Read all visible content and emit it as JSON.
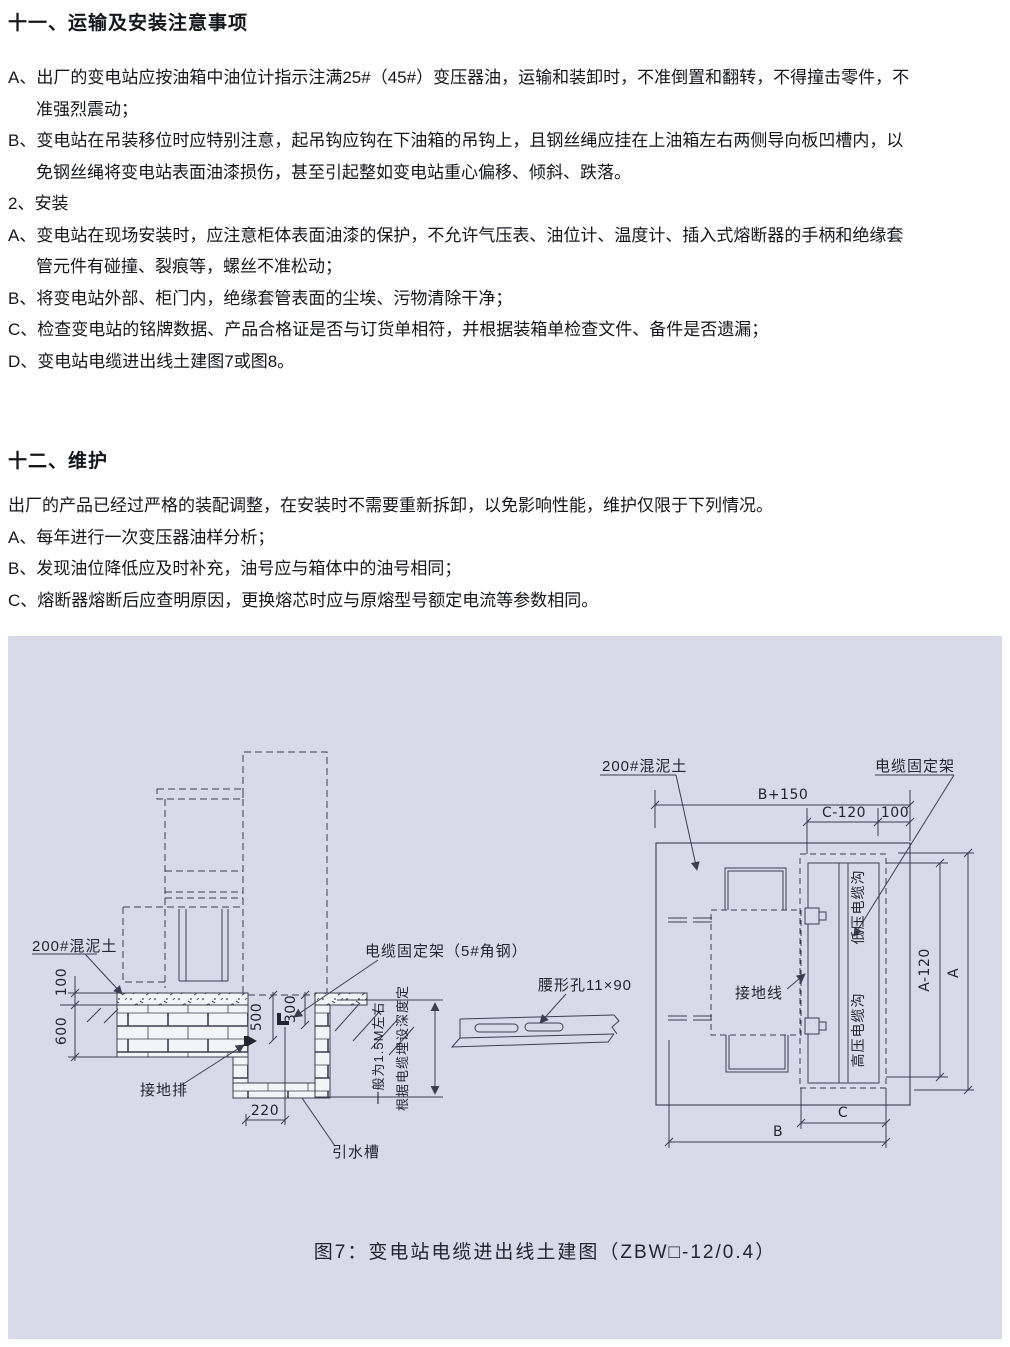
{
  "doc": {
    "section11": {
      "heading": "十一、运输及安装注意事项",
      "lines": [
        "A、出厂的变电站应按油箱中油位计指示注满25#（45#）变压器油，运输和装卸时，不准倒置和翻转，不得撞击零件，不",
        "准强烈震动；",
        "B、变电站在吊装移位时应特别注意，起吊钩应钩在下油箱的吊钩上，且钢丝绳应挂在上油箱左右两侧导向板凹槽内，以",
        "免钢丝绳将变电站表面油漆损伤，甚至引起整如变电站重心偏移、倾斜、跌落。",
        "2、安装",
        "A、变电站在现场安装时，应注意柜体表面油漆的保护，不允许气压表、油位计、温度计、插入式熔断器的手柄和绝缘套",
        "管元件有碰撞、裂痕等，螺丝不准松动；",
        "B、将变电站外部、柜门内，绝缘套管表面的尘埃、污物清除干净；",
        "C、检查变电站的铭牌数据、产品合格证是否与订货单相符，并根据装箱单检查文件、备件是否遗漏；",
        "D、变电站电缆进出线土建图7或图8。"
      ]
    },
    "section12": {
      "heading": "十二、维护",
      "lines": [
        "出厂的产品已经过严格的装配调整，在安装时不需要重新拆卸，以免影响性能，维护仅限于下列情况。",
        "A、每年进行一次变压器油样分析；",
        "B、发现油位降低应及时补充，油号应与箱体中的油号相同；",
        "C、熔断器熔断后应查明原因，更换熔芯时应与原熔型号额定电流等参数相同。"
      ]
    }
  },
  "figure": {
    "caption": "图7：变电站电缆进出线土建图（ZBW□-12/0.4）",
    "labels": {
      "concrete_section": "200#混泥土",
      "concrete_plan": "200#混泥土",
      "cable_bracket_steel": "电缆固定架（5#角钢）",
      "cable_bracket": "电缆固定架",
      "slot_hole": "腰形孔11×90",
      "ground_bar": "接地排",
      "drain": "引水槽",
      "ground_wire": "接地线",
      "lv_trench": "低压电缆沟",
      "hv_trench": "高压电缆沟",
      "depth_note_1": "根据电缆埋设深度定",
      "depth_note_2": "一般为1.5M左右"
    },
    "dims": {
      "d100": "100",
      "d600": "600",
      "d500": "500",
      "d300": "300",
      "d220": "220",
      "b_plus_150": "B+150",
      "c_minus_120": "C-120",
      "d100_edge": "100",
      "a_minus_120": "A-120",
      "a": "A",
      "c": "C",
      "b": "B"
    },
    "colors": {
      "panel_bg": "#d8daea",
      "line": "#3c3e50",
      "text": "#23242e"
    }
  }
}
